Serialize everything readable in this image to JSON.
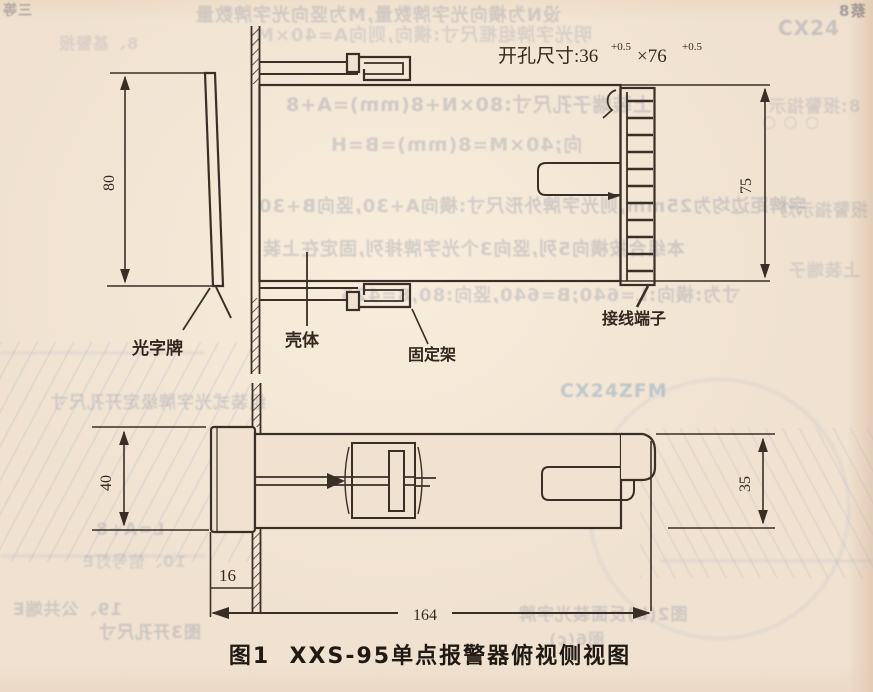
{
  "figure": {
    "caption": "图1  XXS-95单点报警器俯视侧视图",
    "cutout_label": "开孔尺寸:36",
    "cutout_width_tol": "+0.5",
    "cutout_times_height": "×76",
    "cutout_height_tol": "+0.5"
  },
  "part_labels": {
    "light_plate": "光字牌",
    "housing": "壳体",
    "bracket": "固定架",
    "terminal": "接线端子"
  },
  "dimensions": {
    "bezel_width": "80",
    "body_width": "75",
    "bezel_height": "40",
    "body_height": "35",
    "bezel_depth": "16",
    "total_length": "164"
  },
  "colors": {
    "ink": "#3a2f26",
    "paper": "#f0e1d0"
  },
  "bleed_through": {
    "items": [
      {
        "text": "设N为横向光字牌数量,M为竖向光字牌数量"
      },
      {
        "text": "明光字牌组框尺寸:横向,则向A=40×M"
      },
      {
        "text": "上装端子孔尺寸:80×N+8(mm)=A+8"
      },
      {
        "text": "向;40×M=8(mm)=B=H"
      },
      {
        "text": "字牌距边均为25mm,则光字牌外形尺寸:横向A+30,竖向B+30"
      },
      {
        "text": "本组合按横向5列,竖向3个光字牌排列,固定在上装"
      },
      {
        "text": "寸为:横向:L=640;B=640,竖向:80,8=425"
      },
      {
        "text": "CX24"
      },
      {
        "text": "8:报警指示"
      },
      {
        "text": "○ ○ ○"
      },
      {
        "text": "报警指示灯"
      },
      {
        "text": "上装端子"
      },
      {
        "text": "组装式光字牌级定开孔尺寸"
      },
      {
        "text": "CX24ZFM"
      },
      {
        "text": "L=A+8"
      },
      {
        "text": "10、信号灯E"
      },
      {
        "text": "19、公共端E"
      },
      {
        "text": "图3开孔尺寸"
      },
      {
        "text": "图2(b)反面装光字牌"
      },
      {
        "text": "图6(c)"
      },
      {
        "text": "蔡8"
      },
      {
        "text": "三等"
      },
      {
        "text": "8、基警报"
      }
    ]
  }
}
